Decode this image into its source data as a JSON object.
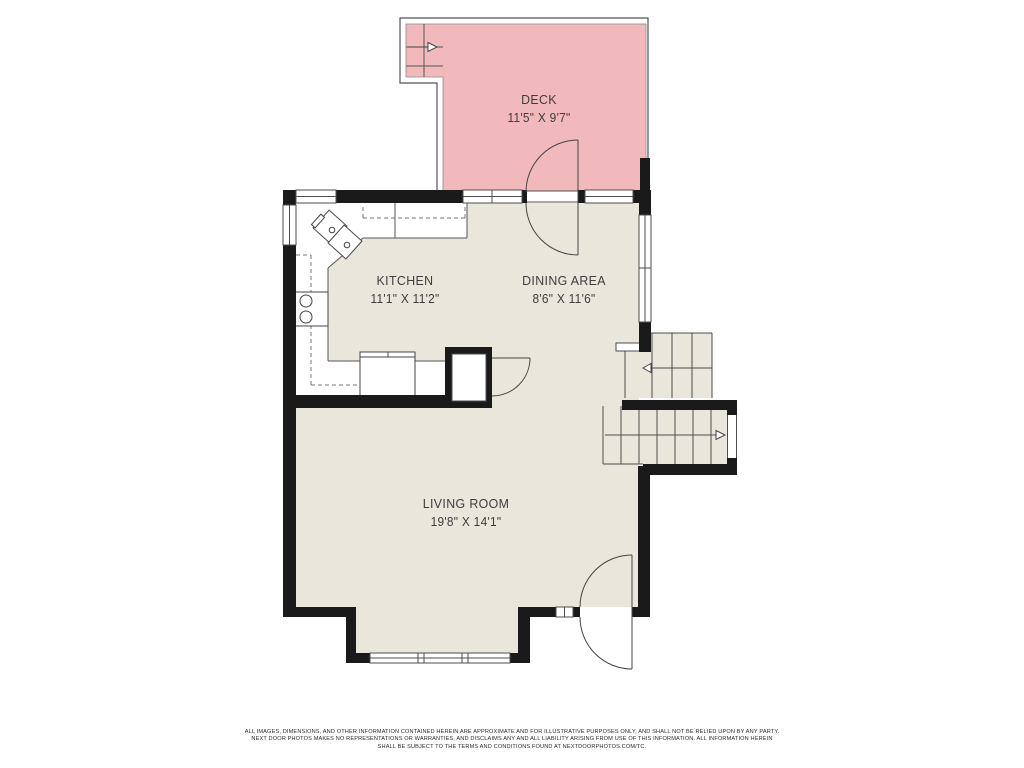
{
  "floorplan": {
    "rooms": [
      {
        "name": "DECK",
        "dims": "11'5\" X 9'7\""
      },
      {
        "name": "KITCHEN",
        "dims": "11'1\" X 11'2\""
      },
      {
        "name": "DINING AREA",
        "dims": "8'6\" X 11'6\""
      },
      {
        "name": "LIVING ROOM",
        "dims": "19'8\" X 14'1\""
      }
    ],
    "colors": {
      "deck_fill": "#f2b9bd",
      "floor_fill": "#e9e6db",
      "wall_color": "#1a1a1a",
      "line_color": "#4d4d4d",
      "text_color": "#3d3d3d",
      "background": "#ffffff"
    },
    "icons": [
      "stair-direction-arrow-right-deck",
      "stair-direction-arrow-left-upper",
      "stair-direction-arrow-right-lower"
    ],
    "disclaimer": {
      "line1": "ALL IMAGES, DIMENSIONS, AND OTHER INFORMATION CONTAINED HEREIN ARE APPROXIMATE AND FOR ILLUSTRATIVE PURPOSES ONLY, AND SHALL NOT BE RELIED UPON BY ANY PARTY.",
      "line2": "NEXT DOOR PHOTOS MAKES NO REPRESENTATIONS OR WARRANTIES, AND DISCLAIMS ANY AND ALL LIABILITY ARISING FROM USE OF THIS INFORMATION. ALL INFORMATION HEREIN",
      "line3": "SHALL BE SUBJECT TO THE TERMS AND CONDITIONS FOUND AT NEXTDOORPHOTOS.COM/TC."
    }
  }
}
